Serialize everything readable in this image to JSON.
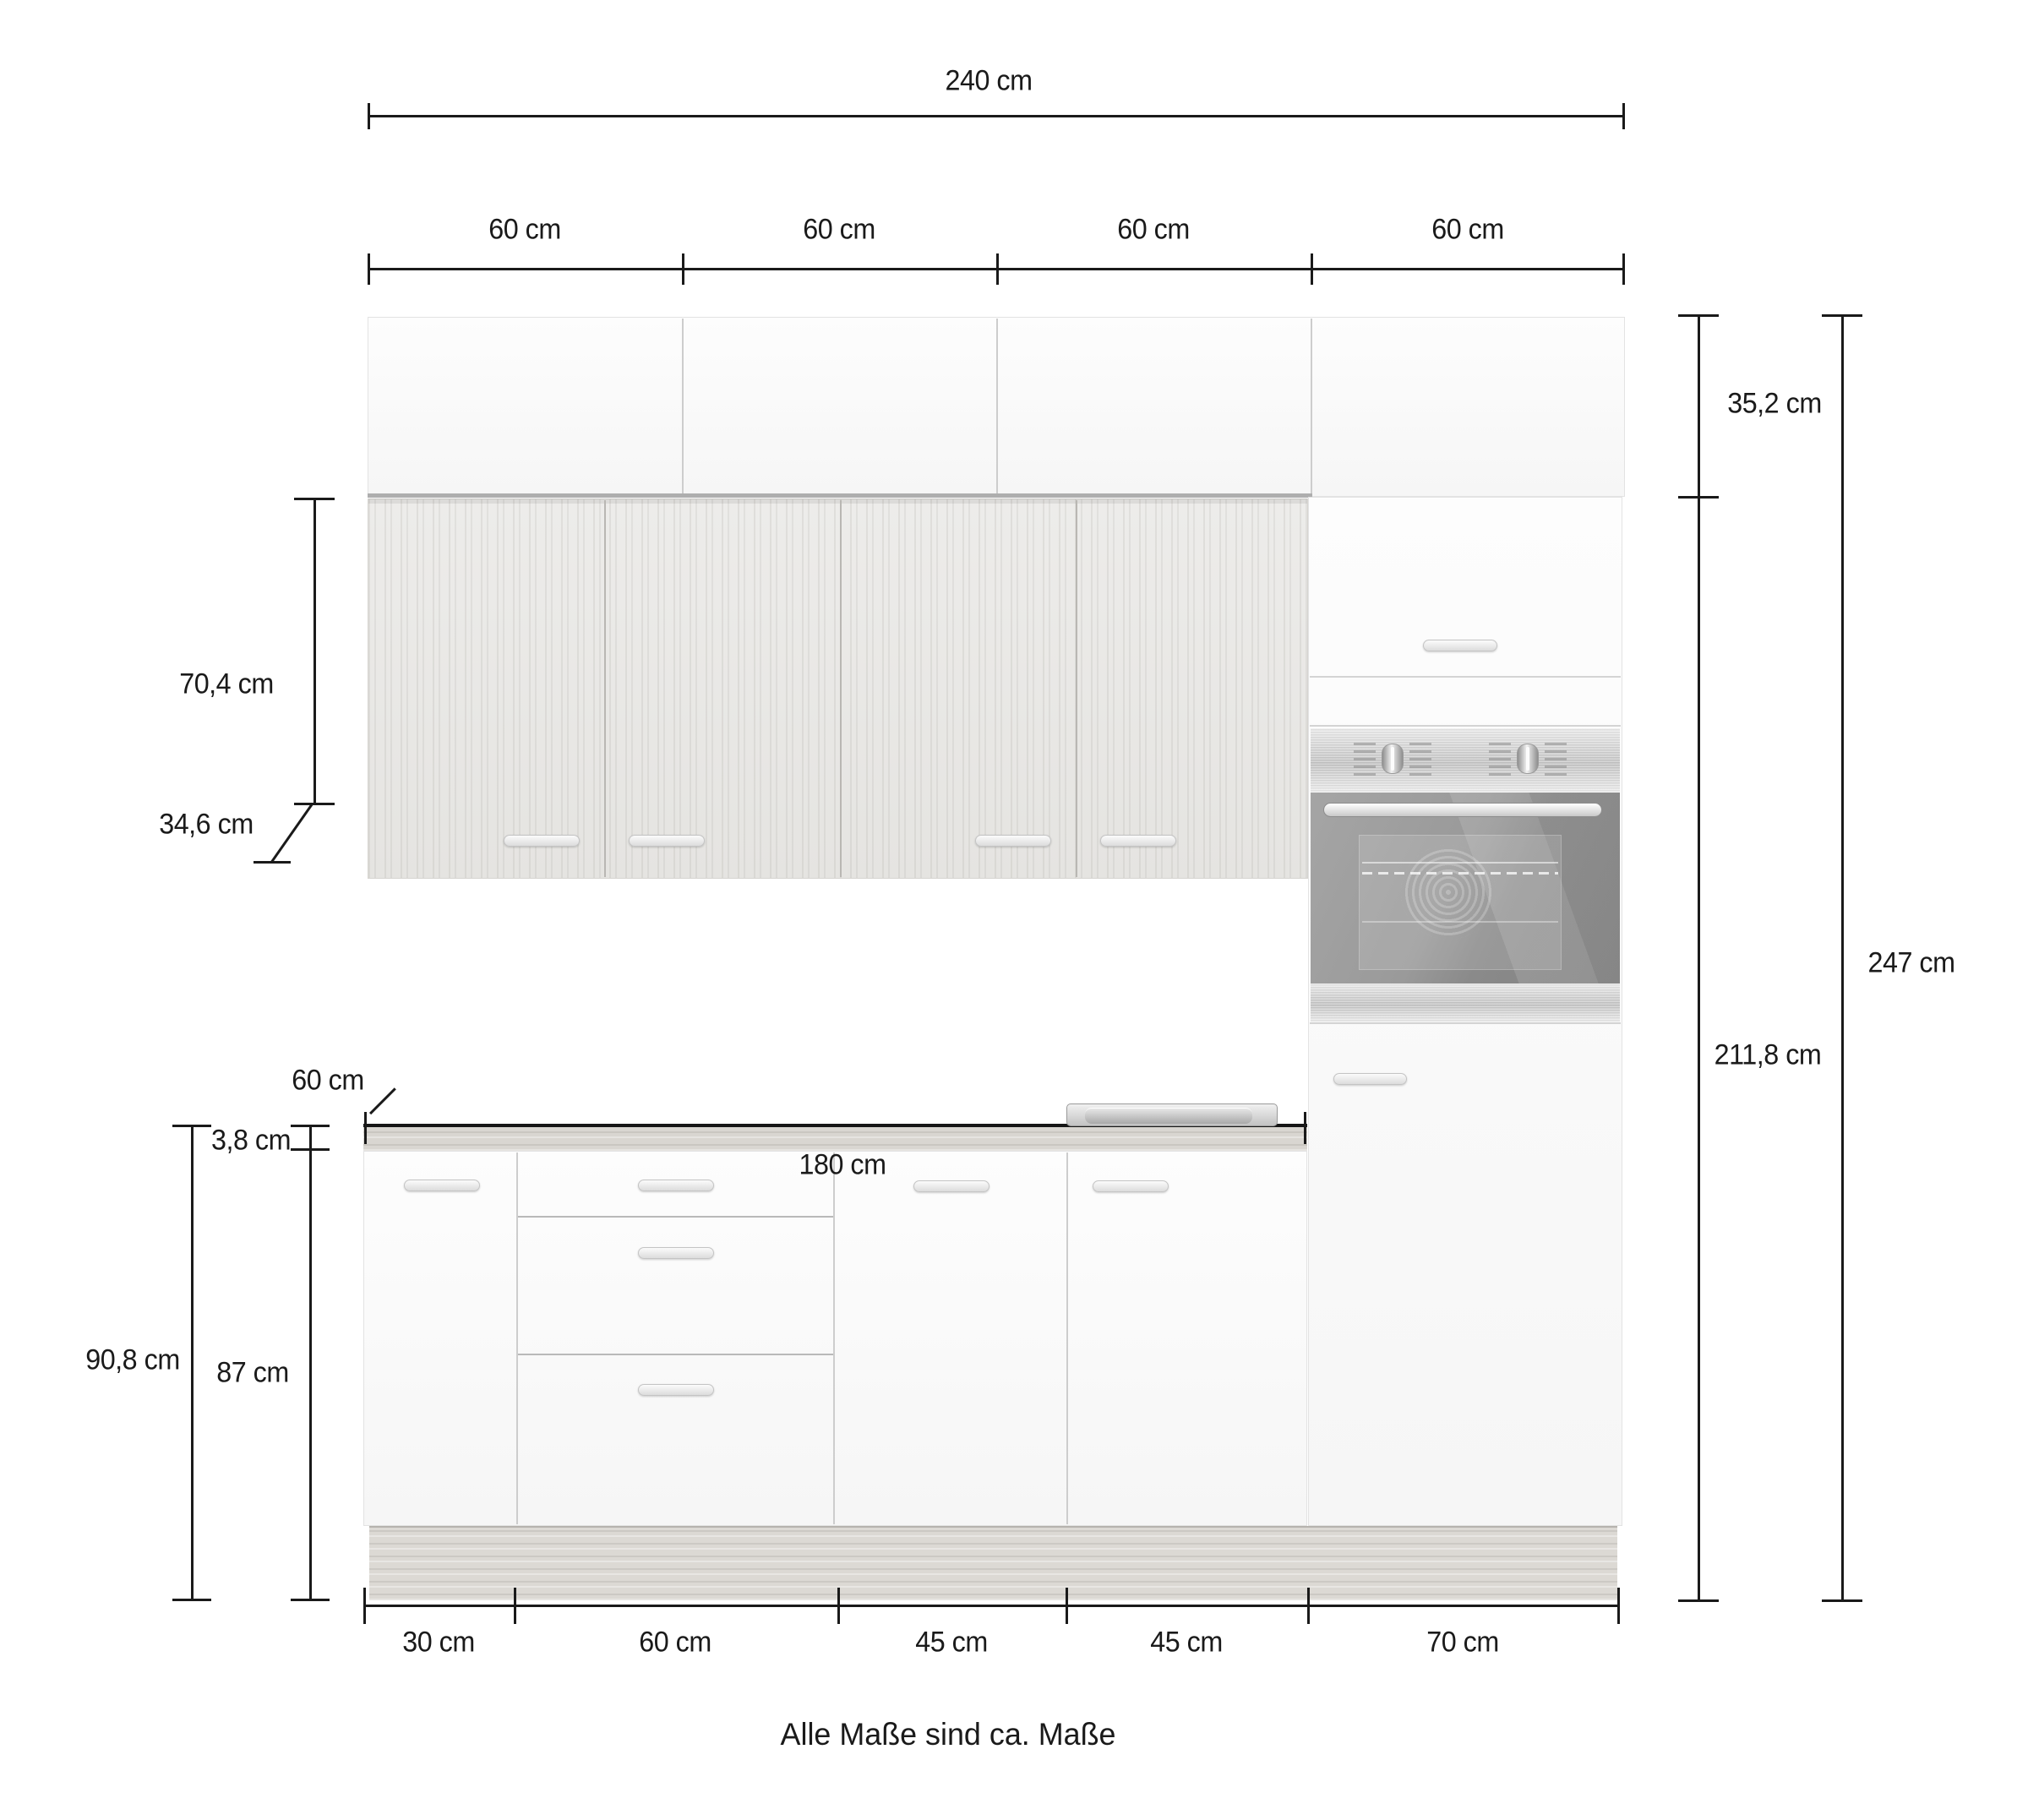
{
  "diagram": {
    "title_note": "Alle Maße sind ca. Maße",
    "dims": {
      "total_width": "240 cm",
      "upper_segments": [
        "60 cm",
        "60 cm",
        "60 cm",
        "60 cm"
      ],
      "upper_cabinet_height": "35,2 cm",
      "wall_cabinet_height": "70,4 cm",
      "wall_cabinet_depth": "34,6 cm",
      "tall_column_height": "211,8 cm",
      "total_height": "247 cm",
      "worktop_depth": "60 cm",
      "worktop_thickness": "3,8 cm",
      "base_total_height": "90,8 cm",
      "base_cabinet_height": "87 cm",
      "worktop_width": "180 cm",
      "base_segments": [
        "30 cm",
        "60 cm",
        "45 cm",
        "45 cm",
        "70 cm"
      ]
    }
  }
}
